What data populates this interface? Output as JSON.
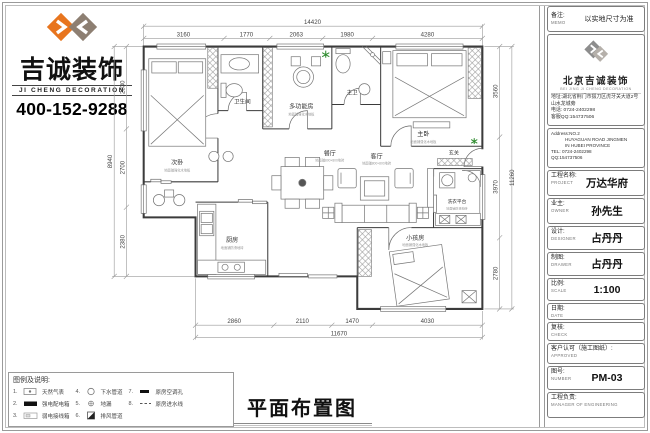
{
  "brand": {
    "name_cn": "吉诚装饰",
    "name_en": "JI CHENG DECORATION",
    "phone": "400-152-9288",
    "accent_orange": "#e8751e",
    "accent_taupe": "#8d7f72"
  },
  "drawing_title": "平面布置图",
  "memo": {
    "label_cn": "备注:",
    "label_en": "MEMO",
    "value": "以实地尺寸为准"
  },
  "company": {
    "name_cn": "北京吉诚装饰",
    "name_en": "BEI JING JI CHENG DECORATION",
    "address_cn": "地址:湖北省荆门市掇刀区虎牙关大道2号山水龙城旁",
    "tel_cn": "电话: 0724-2402298",
    "qq_cn": "客服QQ:154737506",
    "address_en_1": "Address:NO.2",
    "address_en_2": "HUYAGUAN ROAD JINGMEN",
    "address_en_3": "IN HUBEI PROVINCE",
    "tel_en": "TEL: 0724-2402298",
    "qq_en": "QQ:154737506"
  },
  "fields": [
    {
      "label_cn": "工程名称:",
      "label_en": "PROJECT",
      "value": "万达华府"
    },
    {
      "label_cn": "业主:",
      "label_en": "OWNER",
      "value": "孙先生"
    },
    {
      "label_cn": "设计:",
      "label_en": "DESIGNER",
      "value": "占丹丹"
    },
    {
      "label_cn": "制图:",
      "label_en": "DRAWER",
      "value": "占丹丹"
    },
    {
      "label_cn": "比例:",
      "label_en": "SCALE",
      "value": "1:100"
    },
    {
      "label_cn": "日期:",
      "label_en": "DATE",
      "value": ""
    },
    {
      "label_cn": "复核:",
      "label_en": "CHECK",
      "value": ""
    },
    {
      "label_cn": "客户认可（施工图纸）:",
      "label_en": "APPROVED",
      "value": ""
    },
    {
      "label_cn": "图号:",
      "label_en": "NUMBER",
      "value": "PM-03"
    },
    {
      "label_cn": "工程负责:",
      "label_en": "MANAGER OF ENGINEERING",
      "value": ""
    }
  ],
  "legend": {
    "title": "图例及说明:",
    "items": [
      {
        "no": "1.",
        "label": "天然气表"
      },
      {
        "no": "2.",
        "label": "强电配电箱"
      },
      {
        "no": "3.",
        "label": "弱电接线箱"
      },
      {
        "no": "4.",
        "label": "下水管道"
      },
      {
        "no": "5.",
        "label": "地漏"
      },
      {
        "no": "6.",
        "label": "排风管道"
      },
      {
        "no": "7.",
        "label": "原房空调孔"
      },
      {
        "no": "8.",
        "label": "原房进水线"
      }
    ]
  },
  "plan": {
    "rooms": [
      {
        "name": "次卧",
        "note": "地面铺强化木地板"
      },
      {
        "name": "卫生间",
        "note": ""
      },
      {
        "name": "多功能房",
        "note": "地面铺强化木地板"
      },
      {
        "name": "主卫",
        "note": ""
      },
      {
        "name": "主卧",
        "note": "地面铺强化木地板"
      },
      {
        "name": "餐厅",
        "note": "地面铺800×800地砖"
      },
      {
        "name": "厨房",
        "note": "地面铺防滑地砖"
      },
      {
        "name": "客厅",
        "note": "地面铺800×800地砖"
      },
      {
        "name": "洗衣平台",
        "note": "地面铺防滑地砖"
      },
      {
        "name": "小孩房",
        "note": "地面铺强化木地板"
      },
      {
        "name": "玄关",
        "note": ""
      }
    ],
    "dims": {
      "top": {
        "total": "14420",
        "segments": [
          "3160",
          "1770",
          "2063",
          "1980",
          "4280"
        ]
      },
      "bottom": {
        "total": "11670",
        "segments": [
          "2860",
          "2110",
          "1470",
          "4030"
        ]
      },
      "left": {
        "total": "8940",
        "segments": [
          "2830",
          "2700",
          "2380"
        ]
      },
      "right": {
        "total": "11260",
        "segments": [
          "3560",
          "3970",
          "2780"
        ]
      }
    }
  }
}
